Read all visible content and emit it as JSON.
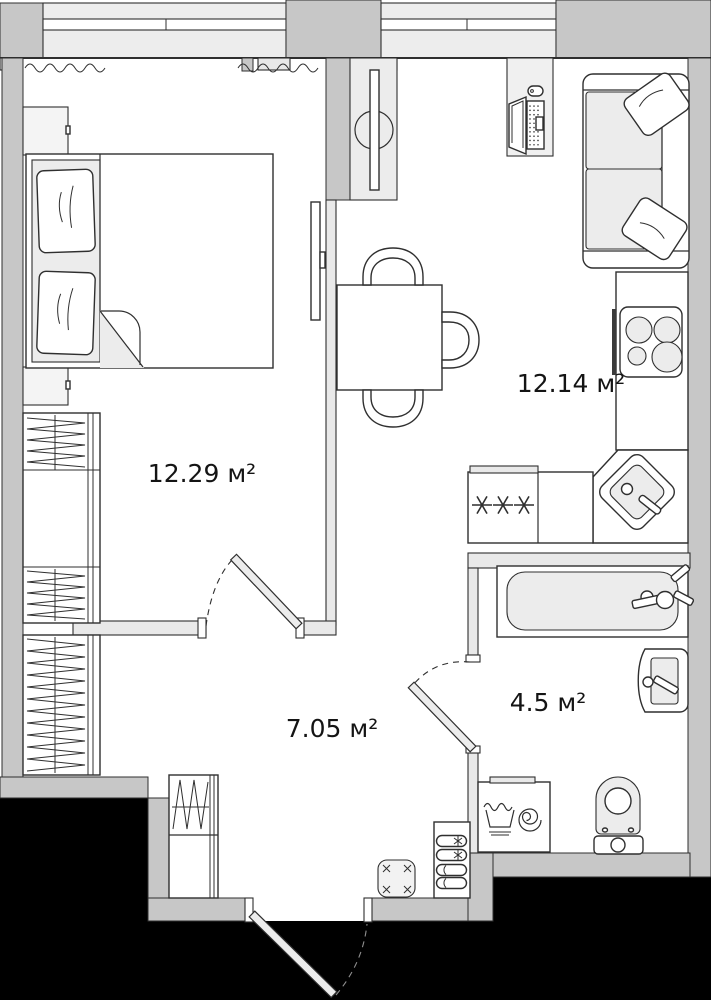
{
  "floorplan": {
    "rooms": {
      "bedroom": {
        "area_label": "12.29 м²"
      },
      "kitchen_living": {
        "area_label": "12.14 м²"
      },
      "hallway": {
        "area_label": "7.05 м²"
      },
      "bathroom": {
        "area_label": "4.5 м²"
      }
    },
    "colors": {
      "outside": "#000000",
      "wall_ext": "#c7c7c7",
      "wall_int": "#e9e9e9",
      "glass": "#ededed",
      "furniture": "#ececec",
      "line": "#2f2f2f",
      "floor": "#ffffff",
      "label_color": "#141414"
    },
    "symbols": [
      "window",
      "curtain",
      "door-swing",
      "bed",
      "pillow",
      "nightstand",
      "wardrobe",
      "tv",
      "tv-stand",
      "desk",
      "laptop",
      "mouse",
      "sofa",
      "dining-table",
      "chair",
      "stove",
      "fridge-snowflakes",
      "kitchen-sink",
      "bathtub",
      "wash-basin",
      "toilet",
      "washing-machine",
      "shoe-rack",
      "pouf"
    ]
  }
}
